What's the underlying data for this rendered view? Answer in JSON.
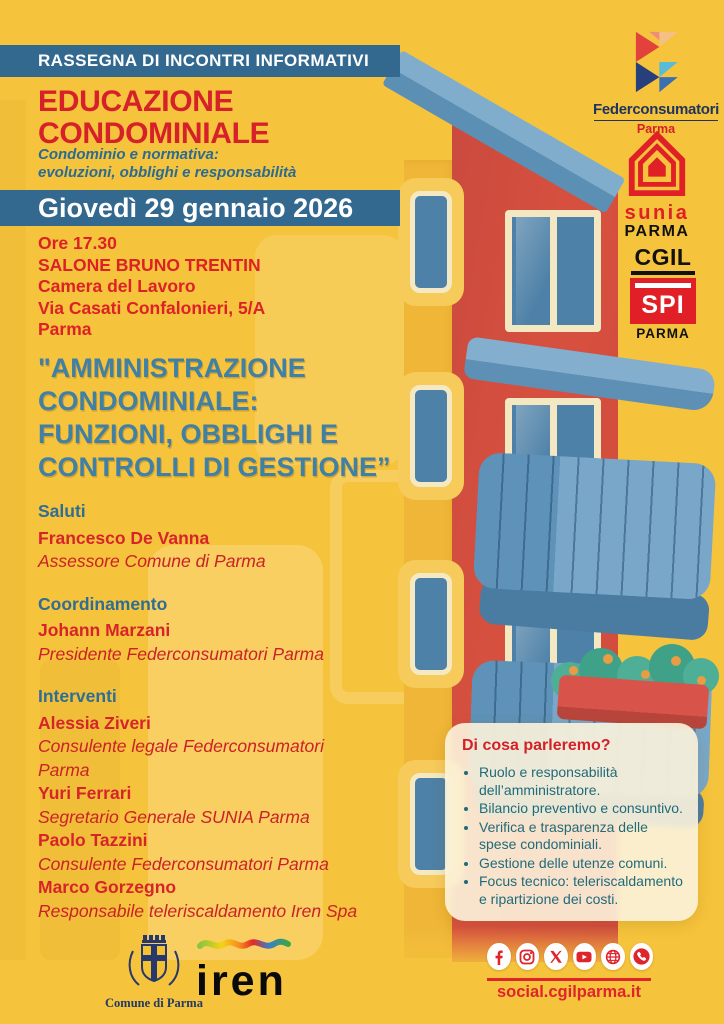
{
  "header": {
    "kicker": "RASSEGNA DI INCONTRI INFORMATIVI",
    "title_line1": "EDUCAZIONE",
    "title_line2": "CONDOMINIALE",
    "subtitle_line1": "Condominio e normativa:",
    "subtitle_line2": "evoluzioni, obblighi e responsabilità",
    "date_banner": "Giovedì 29 gennaio 2026"
  },
  "venue": {
    "time": "Ore 17.30",
    "hall": "SALONE BRUNO TRENTIN",
    "building": "Camera del Lavoro",
    "address": "Via Casati Confalonieri, 5/A",
    "city": "Parma"
  },
  "main_title": {
    "line1": "\"AMMINISTRAZIONE",
    "line2": "CONDOMINIALE:",
    "line3": "FUNZIONI, OBBLIGHI E",
    "line4": "CONTROLLI DI GESTIONE”"
  },
  "program": {
    "sections": [
      {
        "label": "Saluti",
        "speakers": [
          {
            "name": "Francesco De Vanna",
            "role": "Assessore Comune di Parma"
          }
        ]
      },
      {
        "label": "Coordinamento",
        "speakers": [
          {
            "name": "Johann Marzani",
            "role": "Presidente Federconsumatori Parma"
          }
        ]
      },
      {
        "label": "Interventi",
        "speakers": [
          {
            "name": "Alessia Ziveri",
            "role": "Consulente legale Federconsumatori\nParma"
          },
          {
            "name": "Yuri Ferrari",
            "role": "Segretario Generale SUNIA Parma"
          },
          {
            "name": "Paolo Tazzini",
            "role": "Consulente Federconsumatori Parma"
          },
          {
            "name": "Marco Gorzegno",
            "role": "Responsabile teleriscaldamento Iren Spa"
          }
        ]
      }
    ]
  },
  "topics_card": {
    "title": "Di cosa parleremo?",
    "items": [
      "Ruolo e responsabilità dell’amministratore.",
      "Bilancio preventivo e consuntivo.",
      "Verifica e trasparenza delle spese condominiali.",
      "Gestione delle utenze comuni.",
      "Focus tecnico: teleriscaldamento e ripartizione dei costi."
    ]
  },
  "logos": {
    "federconsumatori": {
      "wordmark": "Federconsumatori",
      "city": "Parma"
    },
    "sunia": {
      "wordmark": "sunia",
      "city": "PARMA"
    },
    "cgil_spi": {
      "org": "CGIL",
      "box": "SPI",
      "city": "PARMA"
    },
    "comune": {
      "caption": "Comune di Parma"
    },
    "iren": {
      "wordmark": "iren"
    }
  },
  "footer": {
    "social_icons": [
      "facebook",
      "instagram",
      "x-twitter",
      "youtube",
      "web-globe",
      "whatsapp"
    ],
    "website": "social.cgilparma.it"
  },
  "colors": {
    "background": "#F5C33C",
    "banner_blue": "#33688F",
    "headline_red": "#D6202A",
    "main_title_blue": "#4080A6",
    "bullet_teal": "#206A7A",
    "social_red": "#E0242C",
    "building_red": "#D24C3F",
    "balcony_blue": "#6FA0C4"
  }
}
